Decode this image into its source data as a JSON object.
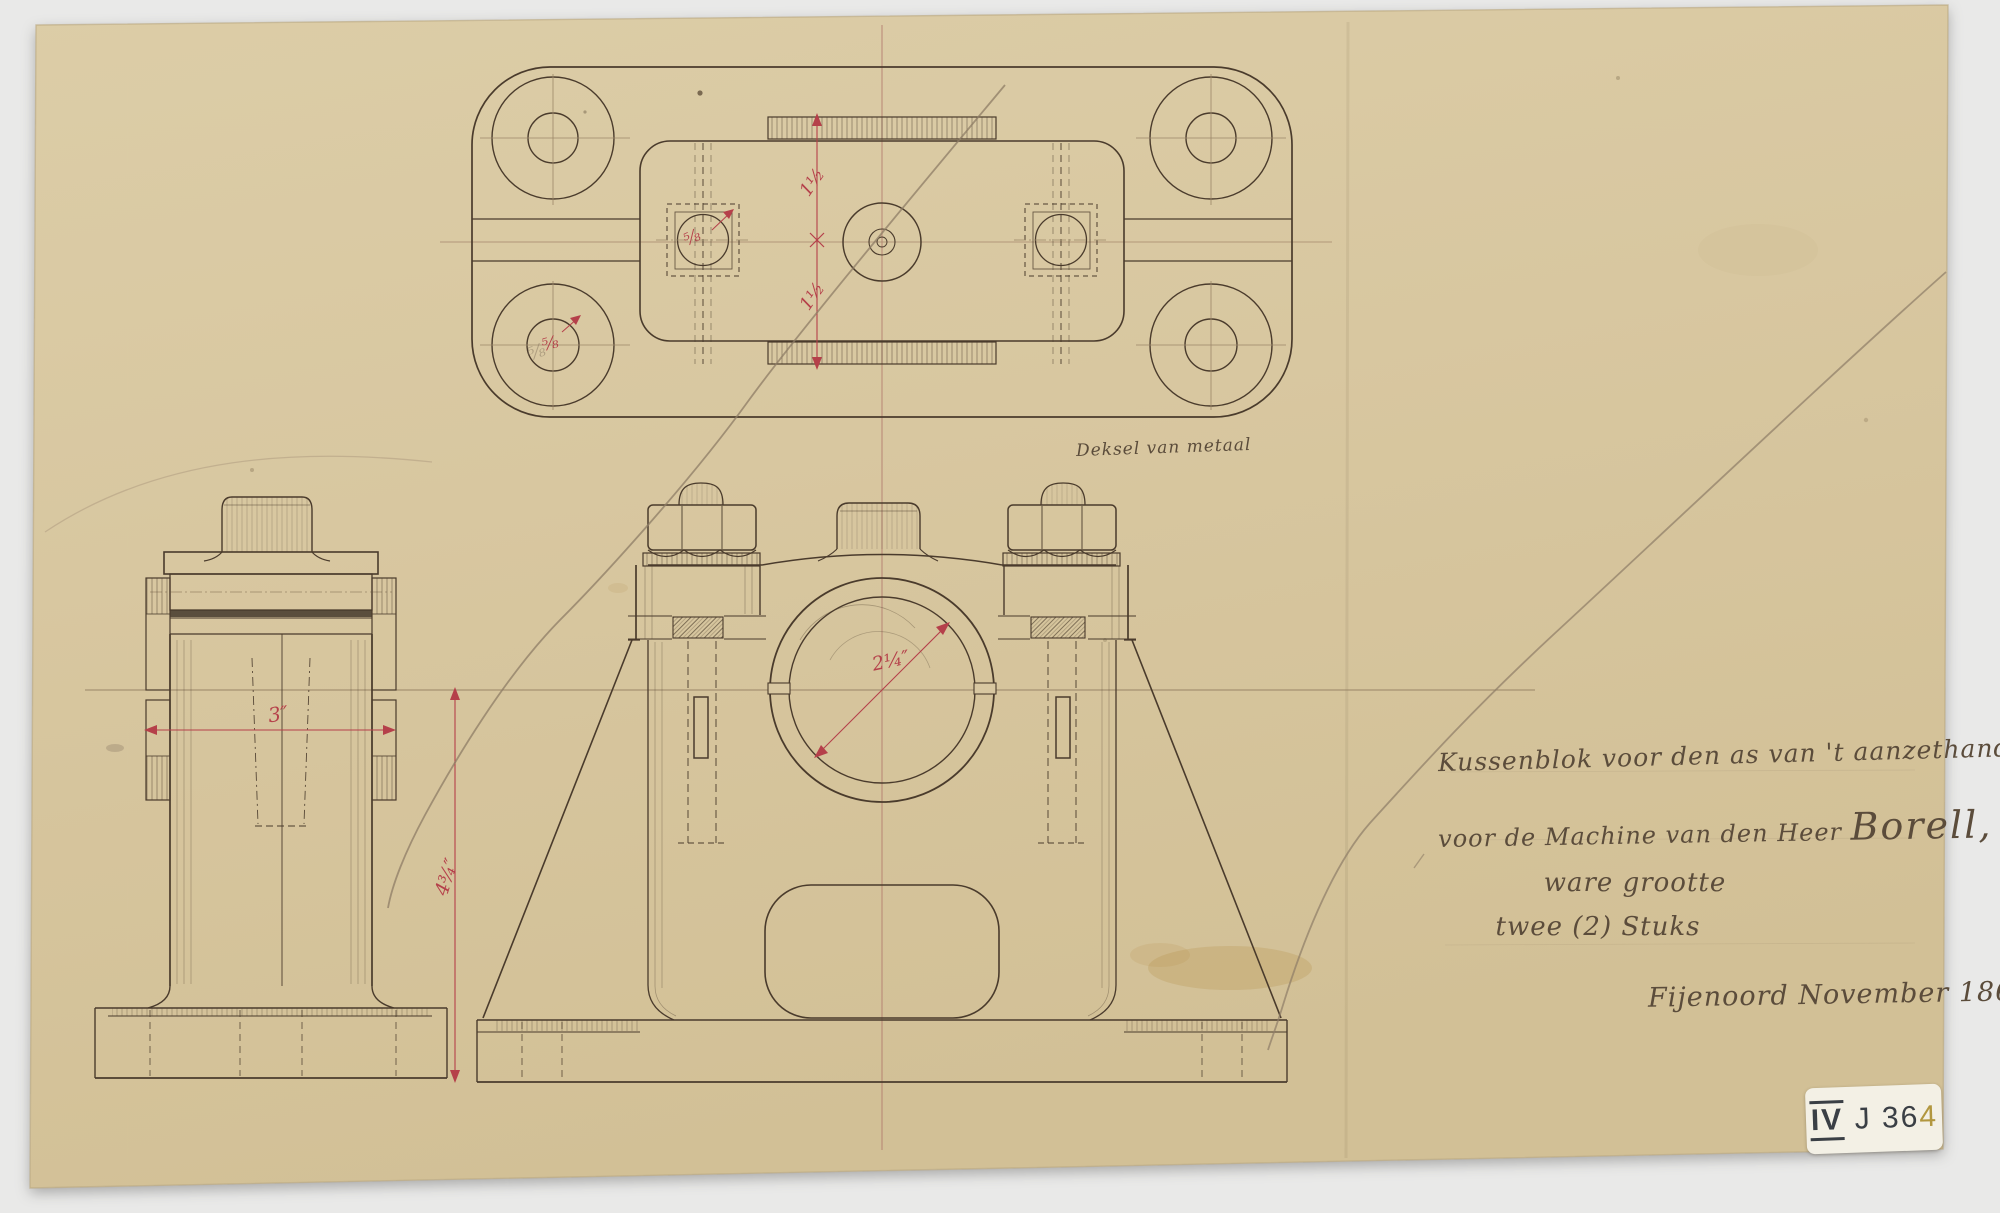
{
  "scan": {
    "colors": {
      "background": "#e9e9e8",
      "paper": "#d8c7a1",
      "ink": "#4a3b2c",
      "pencil": "#8d7c66",
      "dimension_red": "#b5404a",
      "handwriting": "#5b4c3b"
    }
  },
  "annotation": {
    "caption": "Deksel van metaal",
    "line1": "Kussenblok voor den as van 't aanzethandel",
    "line2a": "voor de Machine van den Heer ",
    "line2b": "Borell,",
    "line3": "ware grootte",
    "line4": "twee (2) Stuks",
    "line5": "Fijenoord November 1861"
  },
  "dimensions": {
    "cover_upper_half": "1½",
    "cover_lower_half": "1½",
    "boss_bolt": "⁵⁄₈",
    "corner_bolt": "⁵⁄₈",
    "column_width": "3″",
    "pedestal_height": "4¾″",
    "bore_diameter": "2¼″"
  },
  "archive_sticker": {
    "roman": "IV",
    "mid": " J 36",
    "last": "4"
  }
}
